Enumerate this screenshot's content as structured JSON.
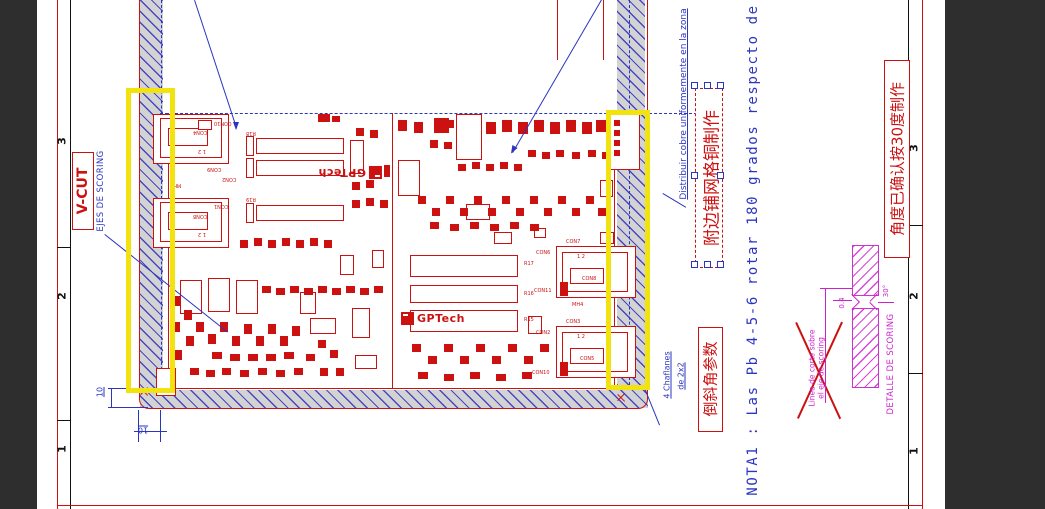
{
  "frame": {
    "zones_left": [
      "3",
      "2",
      "1"
    ],
    "zones_right": [
      "3",
      "2",
      "1"
    ]
  },
  "annotations": {
    "vcut": "V-CUT",
    "ejes": "EJES DE SCORING",
    "distribuir": "Distribuir cobre uniformemente en la zona",
    "cn_copper": "附边铺网格铜制作",
    "cn_angle": "角度已确认按30度制作",
    "cn_bevel": "倒斜角参数",
    "nota1": "NOTA1 : Las Pb 4-5-6 rotar 180 grados respecto de",
    "chaflanes_l1": "4 Chaflanes",
    "chaflanes_l2": "de 2x2",
    "detalle": "DETALLE DE SCORING",
    "linea_l1": "Linea de corte sobre",
    "linea_l2": "el eje de scoring",
    "dim10_v": "10",
    "dim10_h": "10",
    "angle30": "30°",
    "dim04": "0.4",
    "logo": "GPTech"
  },
  "colors": {
    "red": "#cc1111",
    "blue": "#2a35c0",
    "magenta": "#cc22cc",
    "yellow": "#f2e30e",
    "dark": "#2e2e2e"
  },
  "drawing": {
    "outlines": [
      [
        153,
        114,
        76,
        50
      ],
      [
        160,
        118,
        62,
        40
      ],
      [
        168,
        128,
        40,
        18
      ],
      [
        198,
        120,
        14,
        10
      ],
      [
        153,
        198,
        76,
        50
      ],
      [
        160,
        202,
        62,
        40
      ],
      [
        168,
        212,
        40,
        18
      ],
      [
        246,
        136,
        8,
        20
      ],
      [
        256,
        138,
        88,
        16
      ],
      [
        246,
        158,
        8,
        20
      ],
      [
        256,
        160,
        88,
        16
      ],
      [
        246,
        203,
        8,
        20
      ],
      [
        256,
        205,
        88,
        16
      ],
      [
        350,
        140,
        14,
        34
      ],
      [
        372,
        250,
        12,
        18
      ],
      [
        340,
        255,
        14,
        20
      ],
      [
        180,
        280,
        22,
        34
      ],
      [
        208,
        278,
        22,
        34
      ],
      [
        236,
        280,
        22,
        34
      ],
      [
        300,
        292,
        16,
        22
      ],
      [
        352,
        308,
        18,
        30
      ],
      [
        310,
        318,
        26,
        16
      ],
      [
        355,
        355,
        22,
        14
      ],
      [
        156,
        368,
        20,
        28
      ],
      [
        456,
        114,
        26,
        46
      ],
      [
        398,
        160,
        22,
        36
      ],
      [
        466,
        204,
        24,
        16
      ],
      [
        494,
        232,
        18,
        12
      ],
      [
        534,
        228,
        12,
        10
      ],
      [
        410,
        255,
        108,
        22
      ],
      [
        410,
        285,
        108,
        18
      ],
      [
        410,
        310,
        108,
        22
      ],
      [
        528,
        316,
        14,
        18
      ],
      [
        556,
        246,
        80,
        52
      ],
      [
        562,
        252,
        66,
        40
      ],
      [
        570,
        268,
        34,
        16
      ],
      [
        556,
        326,
        80,
        52
      ],
      [
        562,
        332,
        66,
        40
      ],
      [
        570,
        348,
        34,
        16
      ],
      [
        610,
        112,
        30,
        58
      ],
      [
        600,
        180,
        13,
        17
      ],
      [
        600,
        232,
        14,
        12
      ]
    ],
    "filled": [
      [
        434,
        118,
        15,
        15
      ],
      [
        614,
        120,
        6,
        6
      ],
      [
        614,
        130,
        6,
        6
      ],
      [
        614,
        140,
        6,
        6
      ],
      [
        614,
        150,
        6,
        6
      ],
      [
        560,
        282,
        8,
        14
      ],
      [
        560,
        362,
        8,
        14
      ],
      [
        172,
        296,
        8,
        10
      ],
      [
        184,
        310,
        8,
        10
      ],
      [
        172,
        322,
        8,
        10
      ],
      [
        186,
        336,
        8,
        10
      ],
      [
        174,
        350,
        8,
        10
      ],
      [
        196,
        322,
        8,
        10
      ],
      [
        208,
        334,
        8,
        10
      ],
      [
        220,
        322,
        8,
        10
      ],
      [
        232,
        336,
        8,
        10
      ],
      [
        244,
        324,
        8,
        10
      ],
      [
        256,
        336,
        8,
        10
      ],
      [
        268,
        324,
        8,
        10
      ],
      [
        280,
        336,
        8,
        10
      ],
      [
        292,
        326,
        8,
        10
      ],
      [
        212,
        352,
        10,
        7
      ],
      [
        230,
        354,
        10,
        7
      ],
      [
        248,
        354,
        10,
        7
      ],
      [
        266,
        354,
        10,
        7
      ],
      [
        284,
        352,
        10,
        7
      ],
      [
        190,
        368,
        9,
        7
      ],
      [
        206,
        370,
        9,
        7
      ],
      [
        222,
        368,
        9,
        7
      ],
      [
        240,
        370,
        9,
        7
      ],
      [
        258,
        368,
        9,
        7
      ],
      [
        276,
        370,
        9,
        7
      ],
      [
        294,
        368,
        9,
        7
      ],
      [
        306,
        354,
        9,
        7
      ],
      [
        318,
        340,
        8,
        8
      ],
      [
        330,
        350,
        8,
        8
      ],
      [
        320,
        368,
        8,
        8
      ],
      [
        336,
        368,
        8,
        8
      ],
      [
        262,
        286,
        9,
        7
      ],
      [
        276,
        288,
        9,
        7
      ],
      [
        290,
        286,
        9,
        7
      ],
      [
        304,
        288,
        9,
        7
      ],
      [
        318,
        286,
        9,
        7
      ],
      [
        332,
        288,
        9,
        7
      ],
      [
        346,
        286,
        9,
        7
      ],
      [
        360,
        288,
        9,
        7
      ],
      [
        374,
        286,
        9,
        7
      ],
      [
        240,
        240,
        8,
        8
      ],
      [
        254,
        238,
        8,
        8
      ],
      [
        268,
        240,
        8,
        8
      ],
      [
        282,
        238,
        8,
        8
      ],
      [
        296,
        240,
        8,
        8
      ],
      [
        310,
        238,
        8,
        8
      ],
      [
        324,
        240,
        8,
        8
      ],
      [
        352,
        200,
        8,
        8
      ],
      [
        366,
        198,
        8,
        8
      ],
      [
        380,
        200,
        8,
        8
      ],
      [
        352,
        182,
        8,
        8
      ],
      [
        366,
        180,
        8,
        8
      ],
      [
        370,
        130,
        8,
        8
      ],
      [
        356,
        128,
        8,
        8
      ],
      [
        384,
        165,
        6,
        12
      ],
      [
        318,
        114,
        12,
        8
      ],
      [
        332,
        116,
        8,
        6
      ],
      [
        398,
        120,
        9,
        11
      ],
      [
        414,
        122,
        9,
        11
      ],
      [
        430,
        140,
        8,
        8
      ],
      [
        446,
        120,
        8,
        8
      ],
      [
        486,
        122,
        10,
        12
      ],
      [
        502,
        120,
        10,
        12
      ],
      [
        518,
        122,
        10,
        12
      ],
      [
        534,
        120,
        10,
        12
      ],
      [
        550,
        122,
        10,
        12
      ],
      [
        566,
        120,
        10,
        12
      ],
      [
        582,
        122,
        10,
        12
      ],
      [
        596,
        120,
        10,
        12
      ],
      [
        444,
        142,
        8,
        7
      ],
      [
        458,
        164,
        8,
        7
      ],
      [
        472,
        162,
        8,
        7
      ],
      [
        486,
        164,
        8,
        7
      ],
      [
        500,
        162,
        8,
        7
      ],
      [
        514,
        164,
        8,
        7
      ],
      [
        528,
        150,
        8,
        7
      ],
      [
        542,
        152,
        8,
        7
      ],
      [
        556,
        150,
        8,
        7
      ],
      [
        572,
        152,
        8,
        7
      ],
      [
        588,
        150,
        8,
        7
      ],
      [
        602,
        152,
        8,
        7
      ],
      [
        418,
        196,
        8,
        8
      ],
      [
        432,
        208,
        8,
        8
      ],
      [
        446,
        196,
        8,
        8
      ],
      [
        460,
        208,
        8,
        8
      ],
      [
        474,
        196,
        8,
        8
      ],
      [
        488,
        208,
        8,
        8
      ],
      [
        502,
        196,
        8,
        8
      ],
      [
        516,
        208,
        8,
        8
      ],
      [
        530,
        196,
        8,
        8
      ],
      [
        544,
        208,
        8,
        8
      ],
      [
        558,
        196,
        8,
        8
      ],
      [
        572,
        208,
        8,
        8
      ],
      [
        586,
        196,
        8,
        8
      ],
      [
        598,
        208,
        8,
        8
      ],
      [
        430,
        222,
        9,
        7
      ],
      [
        450,
        224,
        9,
        7
      ],
      [
        470,
        222,
        9,
        7
      ],
      [
        490,
        224,
        9,
        7
      ],
      [
        510,
        222,
        9,
        7
      ],
      [
        530,
        224,
        9,
        7
      ],
      [
        412,
        344,
        9,
        8
      ],
      [
        428,
        356,
        9,
        8
      ],
      [
        444,
        344,
        9,
        8
      ],
      [
        460,
        356,
        9,
        8
      ],
      [
        476,
        344,
        9,
        8
      ],
      [
        492,
        356,
        9,
        8
      ],
      [
        508,
        344,
        9,
        8
      ],
      [
        524,
        356,
        9,
        8
      ],
      [
        540,
        344,
        9,
        8
      ],
      [
        418,
        372,
        10,
        7
      ],
      [
        444,
        374,
        10,
        7
      ],
      [
        470,
        372,
        10,
        7
      ],
      [
        496,
        374,
        10,
        7
      ],
      [
        522,
        372,
        10,
        7
      ]
    ],
    "labels": [
      {
        "x": 566,
        "y": 240,
        "t": "CON7"
      },
      {
        "x": 536,
        "y": 251,
        "t": "CON6"
      },
      {
        "x": 582,
        "y": 277,
        "t": "CON8"
      },
      {
        "x": 534,
        "y": 289,
        "t": "CON11"
      },
      {
        "x": 572,
        "y": 303,
        "t": "MH4"
      },
      {
        "x": 566,
        "y": 320,
        "t": "CON3"
      },
      {
        "x": 536,
        "y": 331,
        "t": "CON2"
      },
      {
        "x": 580,
        "y": 357,
        "t": "CON5"
      },
      {
        "x": 532,
        "y": 371,
        "t": "CON10"
      },
      {
        "x": 577,
        "y": 255,
        "t": "1  2"
      },
      {
        "x": 577,
        "y": 335,
        "t": "1  2"
      },
      {
        "x": 524,
        "y": 262,
        "t": "R17"
      },
      {
        "x": 524,
        "y": 292,
        "t": "R16"
      },
      {
        "x": 524,
        "y": 318,
        "t": "R15"
      },
      {
        "x": 214,
        "y": 120,
        "t": "CON10",
        "r": 180
      },
      {
        "x": 193,
        "y": 129,
        "t": "CON4",
        "r": 180
      },
      {
        "x": 207,
        "y": 166,
        "t": "CON9",
        "r": 180
      },
      {
        "x": 222,
        "y": 176,
        "t": "CON2",
        "r": 180
      },
      {
        "x": 214,
        "y": 203,
        "t": "CON1",
        "r": 180
      },
      {
        "x": 193,
        "y": 213,
        "t": "CON8",
        "r": 180
      },
      {
        "x": 170,
        "y": 182,
        "t": "MH4",
        "r": 180
      },
      {
        "x": 198,
        "y": 148,
        "t": "1  2",
        "r": 180
      },
      {
        "x": 198,
        "y": 231,
        "t": "1  2",
        "r": 180
      },
      {
        "x": 246,
        "y": 130,
        "t": "R18",
        "r": 180
      },
      {
        "x": 246,
        "y": 196,
        "t": "R19",
        "r": 180
      }
    ],
    "lines": [
      {
        "x": 195,
        "y": 0,
        "len": 135,
        "ang": 71.8,
        "c": "b",
        "w": 1.3
      },
      {
        "x": 602,
        "y": 0,
        "len": 177,
        "ang": 120.2,
        "c": "b",
        "w": 1.3
      },
      {
        "x": 105,
        "y": 234,
        "len": 157,
        "ang": 38.5,
        "c": "b",
        "w": 1.3
      },
      {
        "x": 663,
        "y": 193,
        "len": 27,
        "ang": 31,
        "c": "b",
        "w": 1.3
      },
      {
        "x": 645,
        "y": 388,
        "len": 40,
        "ang": 67.9,
        "c": "b",
        "w": 1.3
      },
      {
        "x": 797,
        "y": 322,
        "len": 106,
        "ang": 65.4,
        "c": "r",
        "w": 1.6
      },
      {
        "x": 797,
        "y": 418,
        "len": 106,
        "ang": -65.4,
        "c": "r",
        "w": 1.6
      },
      {
        "x": 558,
        "y": 0,
        "len": 60,
        "ang": 90,
        "c": "r",
        "w": 1
      },
      {
        "x": 604,
        "y": 0,
        "len": 60,
        "ang": 90,
        "c": "r",
        "w": 1
      },
      {
        "x": 141,
        "y": 388,
        "len": 10,
        "ang": 45,
        "c": "r",
        "w": 1.4
      },
      {
        "x": 148,
        "y": 388,
        "len": 10,
        "ang": 135,
        "c": "r",
        "w": 1.4
      },
      {
        "x": 618,
        "y": 394,
        "len": 10,
        "ang": 45,
        "c": "r",
        "w": 1.4
      },
      {
        "x": 625,
        "y": 394,
        "len": 10,
        "ang": 135,
        "c": "r",
        "w": 1.4
      },
      {
        "x": 820,
        "y": 288,
        "len": 32,
        "ang": 0,
        "c": "m",
        "w": 1
      },
      {
        "x": 833,
        "y": 300,
        "len": 19,
        "ang": 0,
        "c": "m",
        "w": 1
      },
      {
        "x": 826,
        "y": 288,
        "len": 115,
        "ang": 90,
        "c": "m",
        "w": 1
      },
      {
        "x": 878,
        "y": 302,
        "len": 16,
        "ang": 0,
        "c": "m",
        "w": 1
      },
      {
        "x": 852,
        "y": 294,
        "len": 11,
        "ang": 45,
        "c": "m",
        "w": 1.2
      },
      {
        "x": 860,
        "y": 302,
        "len": 11,
        "ang": 135,
        "c": "m",
        "w": 1.2
      },
      {
        "x": 878,
        "y": 294,
        "len": 11,
        "ang": 135,
        "c": "m",
        "w": 1.2
      },
      {
        "x": 870,
        "y": 302,
        "len": 11,
        "ang": 45,
        "c": "m",
        "w": 1.2
      },
      {
        "x": 108,
        "y": 388,
        "len": 40,
        "ang": 0,
        "c": "b",
        "w": 1
      },
      {
        "x": 108,
        "y": 407,
        "len": 40,
        "ang": 0,
        "c": "b",
        "w": 1
      },
      {
        "x": 112,
        "y": 388,
        "len": 19,
        "ang": 90,
        "c": "b",
        "w": 1
      },
      {
        "x": 139,
        "y": 410,
        "len": 32,
        "ang": 90,
        "c": "b",
        "w": 1
      },
      {
        "x": 161,
        "y": 410,
        "len": 32,
        "ang": 90,
        "c": "b",
        "w": 1
      },
      {
        "x": 134,
        "y": 431,
        "len": 33,
        "ang": 0,
        "c": "b",
        "w": 1
      }
    ],
    "handles": [
      [
        694,
        85
      ],
      [
        707,
        85
      ],
      [
        720,
        85
      ],
      [
        694,
        175
      ],
      [
        720,
        175
      ],
      [
        694,
        264
      ],
      [
        707,
        264
      ],
      [
        720,
        264
      ]
    ]
  }
}
